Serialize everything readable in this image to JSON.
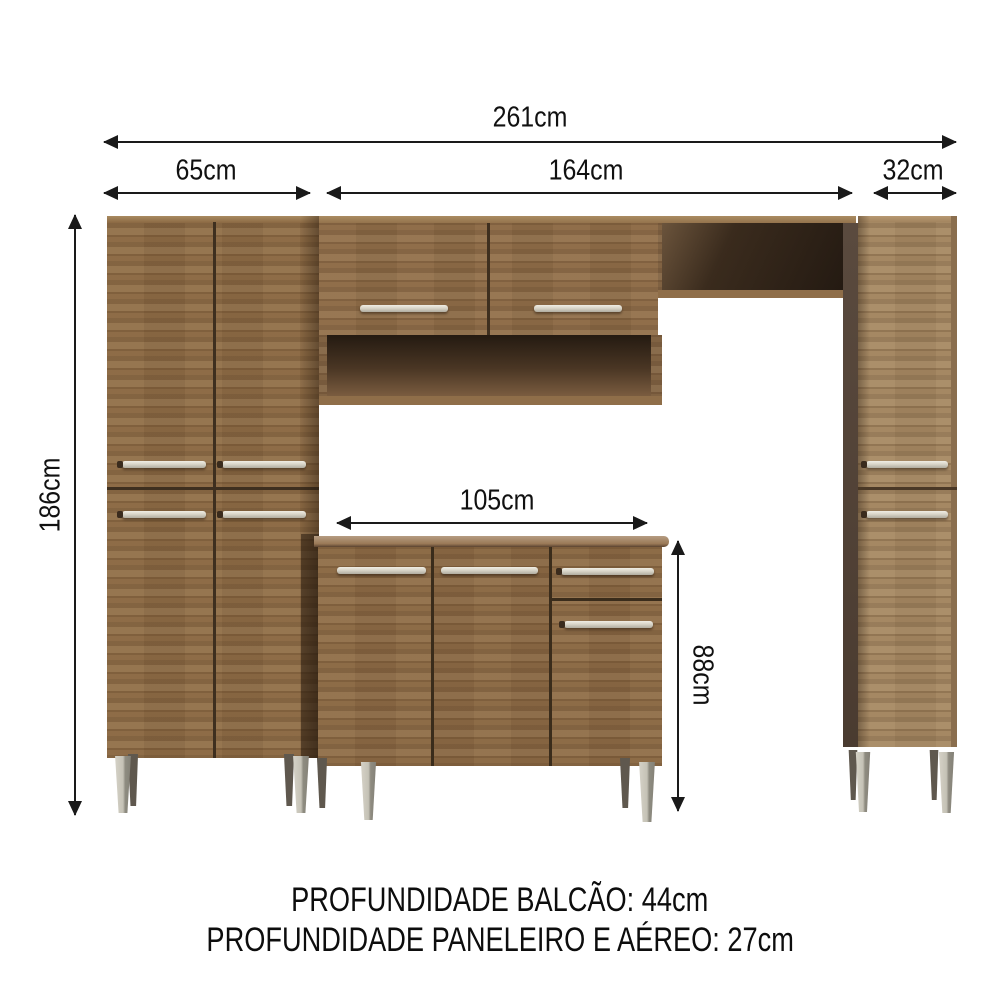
{
  "labels": {
    "total_width": "261cm",
    "left_cabinet_width": "65cm",
    "middle_section_width": "164cm",
    "right_cabinet_width": "32cm",
    "total_height": "186cm",
    "counter_width": "105cm",
    "counter_height": "88cm"
  },
  "footer": {
    "line1": "PROFUNDIDADE BALCÃO: 44cm",
    "line2": "PROFUNDIDADE PANELEIRO E AÉREO: 27cm"
  },
  "colors": {
    "background": "#ffffff",
    "dimension_lines": "#1a1a1a",
    "wood_medium": "#8b6943",
    "wood_counter": "#8a6843",
    "wood_light_right": "#a3855f",
    "niche_interior_dark": "#241a11",
    "side_panel_dark": "#55453a",
    "handle_silver": "#d9d5c9",
    "leg_silver": "#c5c2b6",
    "countertop_light": "#b59c82"
  }
}
